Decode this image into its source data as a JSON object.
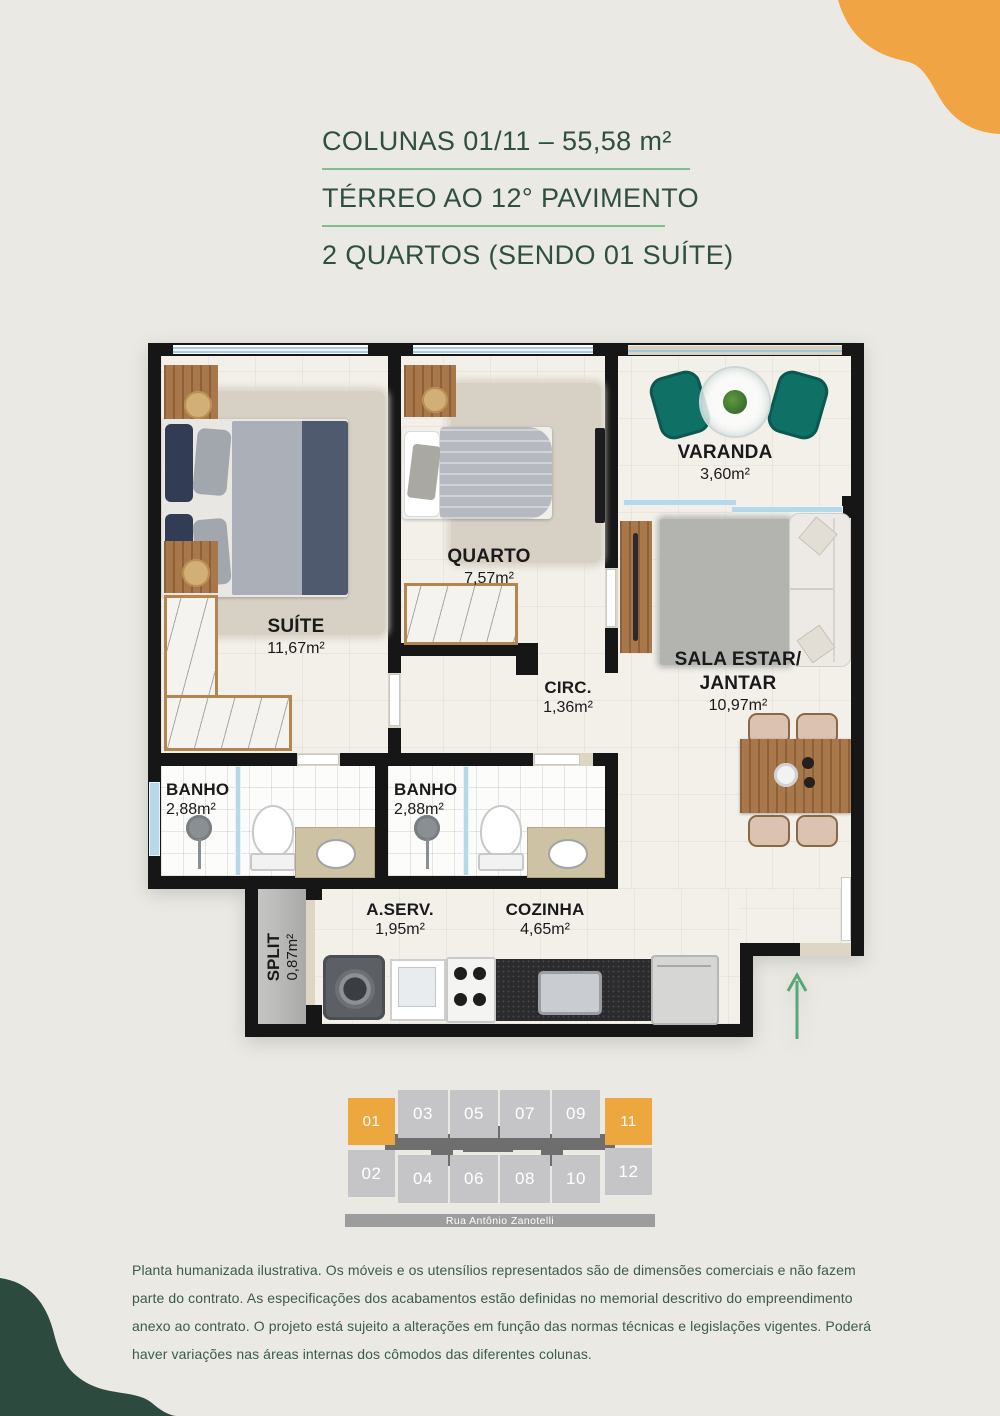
{
  "colors": {
    "background": "#eae9e3",
    "title_green": "#2f4f42",
    "underline_green": "#7fbe8e",
    "accent_orange": "#eca73f",
    "blob_green": "#2c4a3d",
    "wall_black": "#161616",
    "key_gray": "#c5c5c7",
    "arrow_green": "#57a878"
  },
  "header": {
    "line1": "COLUNAS 01/11 – 55,58 m²",
    "line2": "TÉRREO AO 12° PAVIMENTO",
    "line3": "2 QUARTOS (SENDO 01 SUÍTE)"
  },
  "floorplan": {
    "suite": {
      "name": "SUÍTE",
      "area": "11,67m²"
    },
    "quarto": {
      "name": "QUARTO",
      "area": "7,57m²"
    },
    "varanda": {
      "name": "VARANDA",
      "area": "3,60m²"
    },
    "sala": {
      "name1": "SALA ESTAR/",
      "name2": "JANTAR",
      "area": "10,97m²"
    },
    "circ": {
      "name": "CIRC.",
      "area": "1,36m²"
    },
    "banho1": {
      "name": "BANHO",
      "area": "2,88m²"
    },
    "banho2": {
      "name": "BANHO",
      "area": "2,88m²"
    },
    "aserv": {
      "name": "A.SERV.",
      "area": "1,95m²"
    },
    "cozinha": {
      "name": "COZINHA",
      "area": "4,65m²"
    },
    "split": {
      "name": "SPLIT",
      "area": "0,87m²"
    }
  },
  "building_key": {
    "units": [
      {
        "label": "01",
        "highlight": true
      },
      {
        "label": "03",
        "highlight": false
      },
      {
        "label": "05",
        "highlight": false
      },
      {
        "label": "07",
        "highlight": false
      },
      {
        "label": "09",
        "highlight": false
      },
      {
        "label": "11",
        "highlight": true
      },
      {
        "label": "02",
        "highlight": false
      },
      {
        "label": "04",
        "highlight": false
      },
      {
        "label": "06",
        "highlight": false
      },
      {
        "label": "08",
        "highlight": false
      },
      {
        "label": "10",
        "highlight": false
      },
      {
        "label": "12",
        "highlight": false
      }
    ],
    "street": "Rua Antônio Zanotelli"
  },
  "disclaimer": "Planta humanizada ilustrativa. Os móveis e os utensílios representados são de dimensões comerciais e não fazem parte do contrato. As especificações dos acabamentos estão definidas no memorial descritivo do empreendimento anexo ao contrato. O projeto está sujeito a alterações em função das normas técnicas e legislações vigentes. Poderá haver variações nas áreas internas dos cômodos das diferentes colunas."
}
